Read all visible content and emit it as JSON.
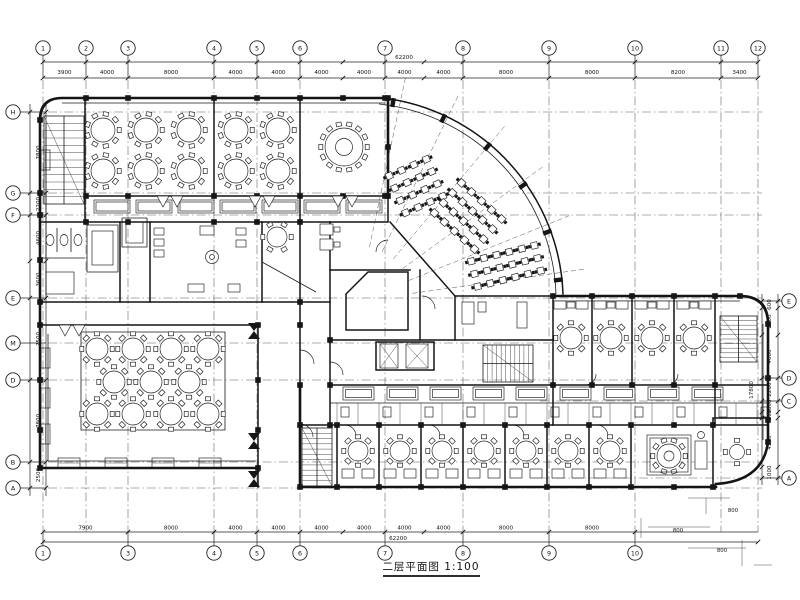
{
  "title": {
    "text": "二层平面图 1:100"
  },
  "grid": {
    "top": {
      "bubbles": [
        "1",
        "2",
        "3",
        "4",
        "5",
        "6",
        "7",
        "8",
        "9",
        "10",
        "11",
        "12"
      ],
      "dims": [
        "3900",
        "4000",
        "8000",
        "4000",
        "4000",
        "4000",
        "4000",
        "4000",
        "4000",
        "8000",
        "8000",
        "8200",
        "3400"
      ],
      "total": "62200"
    },
    "bottom": {
      "bubbles": [
        "1",
        "3",
        "4",
        "5",
        "6",
        "7",
        "8",
        "9",
        "10"
      ],
      "dims": [
        "7900",
        "8000",
        "4000",
        "4000",
        "4000",
        "4000",
        "4000",
        "4000",
        "8000",
        "8000"
      ],
      "total": "62200"
    },
    "left": {
      "bubbles": [
        "H",
        "G",
        "F",
        "E",
        "M",
        "D",
        "B",
        "A"
      ],
      "dims": [
        "7800",
        "2200",
        "4600",
        "3600",
        "7500",
        "7800",
        "2500"
      ]
    },
    "right": {
      "bubbles": [
        "E",
        "D",
        "C",
        "A"
      ],
      "dims": [
        "600",
        "2500",
        "4000",
        "2200",
        "1000",
        "500",
        "4500",
        "1000"
      ],
      "total": "17800"
    }
  },
  "annotations": {
    "detail_dims": [
      "800",
      "800",
      "800"
    ]
  },
  "drawing": {
    "type": "architectural-floor-plan",
    "line_color": "#1a1a1a",
    "background": "#ffffff"
  }
}
